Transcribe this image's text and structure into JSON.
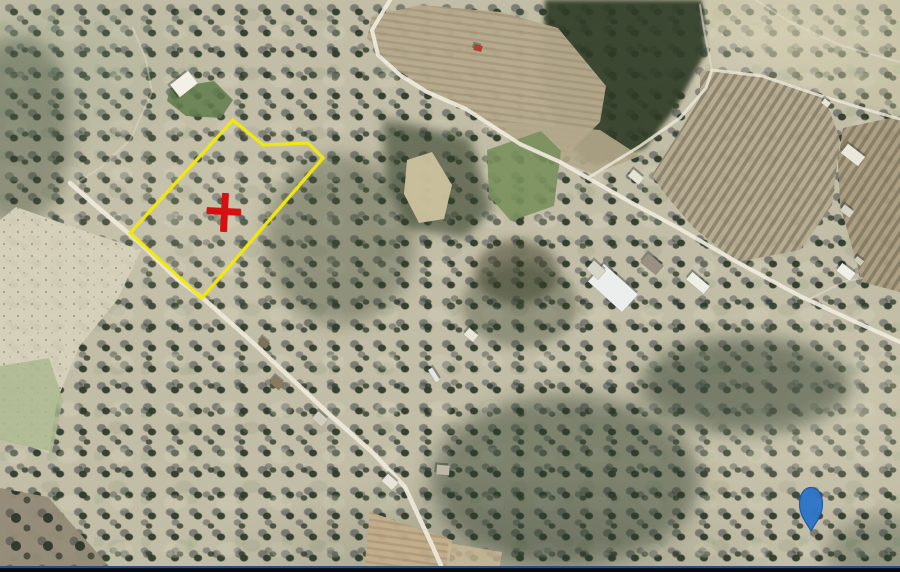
{
  "map": {
    "kind": "satellite-aerial-parcel-view",
    "canvas": {
      "width": 900,
      "height": 572
    },
    "ground_color": "#c2bda6",
    "parcel": {
      "stroke": "#f3e80b",
      "stroke_width": 3.3,
      "vertices": [
        [
          233,
          120
        ],
        [
          263,
          145
        ],
        [
          308,
          143
        ],
        [
          323,
          158
        ],
        [
          202,
          298
        ],
        [
          130,
          233
        ]
      ]
    },
    "markers": {
      "red_cross": {
        "cx": 225,
        "cy": 212,
        "color": "#d61010",
        "h_bar": {
          "x": 206.5,
          "y": 208,
          "w": 34.5,
          "h": 7
        },
        "v_bar": {
          "x": 221,
          "y": 193,
          "w": 7,
          "h": 39
        },
        "tilt_deg": 3
      },
      "blue_pin": {
        "cx": 811,
        "top": 487.5,
        "bulb_cy": 504,
        "r": 11.5,
        "tip_y": 531,
        "fill": "#2d74c9",
        "stroke": "#1e55a0"
      }
    },
    "shades": [
      {
        "name": "forest-top-middle",
        "shape": "polygon",
        "points": [
          [
            545,
            0
          ],
          [
            702,
            0
          ],
          [
            706,
            52
          ],
          [
            676,
            108
          ],
          [
            645,
            148
          ],
          [
            596,
            166
          ],
          [
            558,
            140
          ],
          [
            543,
            78
          ]
        ],
        "fill": "#2d3b27",
        "opacity": 0.9,
        "blur": "s"
      },
      {
        "name": "scrub-mid",
        "shape": "polygon",
        "points": [
          [
            382,
            118
          ],
          [
            470,
            138
          ],
          [
            492,
            210
          ],
          [
            465,
            238
          ],
          [
            408,
            228
          ],
          [
            386,
            180
          ]
        ],
        "fill": "#33402c",
        "opacity": 0.6,
        "blur": "m"
      },
      {
        "name": "dense-right-of-parcel",
        "shape": "ellipse",
        "cx": 340,
        "cy": 240,
        "rx": 75,
        "ry": 85,
        "fill": "#313f2c",
        "opacity": 0.35,
        "blur": "l"
      },
      {
        "name": "dark-patch-mid",
        "shape": "ellipse",
        "cx": 517,
        "cy": 272,
        "rx": 42,
        "ry": 32,
        "fill": "#3a3a28",
        "opacity": 0.5,
        "blur": "m"
      },
      {
        "name": "dark-below-green-field",
        "shape": "ellipse",
        "cx": 520,
        "cy": 305,
        "rx": 58,
        "ry": 42,
        "fill": "#313f2c",
        "opacity": 0.35,
        "blur": "m"
      },
      {
        "name": "dense-bottom-center",
        "shape": "ellipse",
        "cx": 565,
        "cy": 480,
        "rx": 135,
        "ry": 85,
        "fill": "#2c3a29",
        "opacity": 0.45,
        "blur": "l"
      },
      {
        "name": "dense-band-mid-right",
        "shape": "ellipse",
        "cx": 745,
        "cy": 385,
        "rx": 105,
        "ry": 48,
        "fill": "#2c3a29",
        "opacity": 0.5,
        "blur": "l"
      },
      {
        "name": "dense-left-edge",
        "shape": "ellipse",
        "cx": 18,
        "cy": 130,
        "rx": 55,
        "ry": 95,
        "fill": "#2f3d2c",
        "opacity": 0.35,
        "blur": "l"
      },
      {
        "name": "dense-bottom-right-corner",
        "shape": "ellipse",
        "cx": 885,
        "cy": 555,
        "rx": 60,
        "ry": 40,
        "fill": "#2c3a29",
        "opacity": 0.3,
        "blur": "l"
      }
    ],
    "fields": [
      {
        "name": "plowed-field-top-center",
        "fill": "#b6aa8e",
        "opacity": 0.96,
        "texture": "furrows",
        "points": [
          [
            372,
            16
          ],
          [
            420,
            5
          ],
          [
            500,
            12
          ],
          [
            558,
            28
          ],
          [
            606,
            86
          ],
          [
            600,
            122
          ],
          [
            562,
            160
          ],
          [
            520,
            142
          ],
          [
            466,
            108
          ],
          [
            426,
            90
          ],
          [
            386,
            61
          ],
          [
            367,
            38
          ]
        ]
      },
      {
        "name": "tan-strip-above-road",
        "fill": "#b3a78b",
        "opacity": 0.9,
        "points": [
          [
            505,
            122
          ],
          [
            600,
            130
          ],
          [
            640,
            156
          ],
          [
            594,
            174
          ],
          [
            552,
            158
          ],
          [
            508,
            140
          ]
        ]
      },
      {
        "name": "plowed-field-right",
        "fill": "#b6aa90",
        "opacity": 0.95,
        "texture": "rows",
        "points": [
          [
            700,
            70
          ],
          [
            760,
            76
          ],
          [
            802,
            88
          ],
          [
            825,
            98
          ],
          [
            840,
            140
          ],
          [
            832,
            205
          ],
          [
            800,
            250
          ],
          [
            737,
            262
          ],
          [
            694,
            228
          ],
          [
            664,
            193
          ],
          [
            652,
            175
          ],
          [
            682,
            128
          ],
          [
            700,
            98
          ]
        ]
      },
      {
        "name": "vineyard-right-edge",
        "fill": "#ab9d82",
        "opacity": 0.95,
        "texture": "rows",
        "points": [
          [
            843,
            128
          ],
          [
            900,
            116
          ],
          [
            900,
            292
          ],
          [
            862,
            282
          ],
          [
            840,
            205
          ],
          [
            838,
            160
          ]
        ]
      },
      {
        "name": "green-field-center",
        "fill": "#79905c",
        "opacity": 0.9,
        "points": [
          [
            487,
            150
          ],
          [
            541,
            131
          ],
          [
            561,
            151
          ],
          [
            554,
            206
          ],
          [
            511,
            221
          ],
          [
            489,
            196
          ]
        ]
      },
      {
        "name": "green-patch-by-house",
        "fill": "#5f7c4b",
        "opacity": 0.85,
        "points": [
          [
            170,
            88
          ],
          [
            214,
            81
          ],
          [
            233,
            100
          ],
          [
            221,
            118
          ],
          [
            186,
            116
          ],
          [
            167,
            101
          ]
        ]
      },
      {
        "name": "light-field-bottom-left",
        "fill": "#d6d1ba",
        "opacity": 0.95,
        "texture": "speckle",
        "points": [
          [
            16,
            207
          ],
          [
            76,
            228
          ],
          [
            141,
            250
          ],
          [
            117,
            300
          ],
          [
            79,
            347
          ],
          [
            57,
            400
          ],
          [
            49,
            453
          ],
          [
            0,
            437
          ],
          [
            0,
            220
          ]
        ]
      },
      {
        "name": "green-field-bottom-left",
        "fill": "#a9b88e",
        "opacity": 0.8,
        "points": [
          [
            49,
            358
          ],
          [
            63,
            400
          ],
          [
            52,
            452
          ],
          [
            0,
            440
          ],
          [
            0,
            366
          ]
        ]
      },
      {
        "name": "plowed-grove-bottom-left",
        "fill": "#948b78",
        "opacity": 0.97,
        "texture": "trees",
        "points": [
          [
            0,
            488
          ],
          [
            48,
            497
          ],
          [
            114,
            572
          ],
          [
            0,
            572
          ]
        ]
      },
      {
        "name": "dirt-strip-bottom",
        "fill": "#c3ae8b",
        "opacity": 0.95,
        "texture": "furrows",
        "points": [
          [
            370,
            512
          ],
          [
            452,
            540
          ],
          [
            448,
            572
          ],
          [
            364,
            572
          ]
        ]
      },
      {
        "name": "dirt-strip-ext",
        "fill": "#cbb896",
        "opacity": 0.8,
        "points": [
          [
            448,
            543
          ],
          [
            502,
            552
          ],
          [
            499,
            572
          ],
          [
            446,
            572
          ]
        ]
      },
      {
        "name": "bare-soil-patch",
        "fill": "#cec29f",
        "opacity": 0.95,
        "points": [
          [
            407,
            160
          ],
          [
            432,
            152
          ],
          [
            452,
            185
          ],
          [
            444,
            219
          ],
          [
            419,
            223
          ],
          [
            404,
            194
          ]
        ]
      },
      {
        "name": "light-ground-top-right",
        "fill": "#d2cdaa",
        "opacity": 0.3,
        "points": [
          [
            702,
            0
          ],
          [
            900,
            0
          ],
          [
            900,
            112
          ],
          [
            822,
            94
          ],
          [
            756,
            58
          ],
          [
            706,
            20
          ]
        ]
      }
    ],
    "roads": [
      {
        "name": "road-main-diagonal",
        "color": "#eeeadd",
        "width": 4,
        "opacity": 0.92,
        "points": [
          [
            390,
            0
          ],
          [
            372,
            30
          ],
          [
            378,
            55
          ],
          [
            400,
            75
          ],
          [
            427,
            92
          ],
          [
            466,
            109
          ],
          [
            520,
            144
          ],
          [
            560,
            162
          ],
          [
            588,
            178
          ],
          [
            632,
            203
          ],
          [
            680,
            229
          ],
          [
            737,
            262
          ],
          [
            800,
            296
          ],
          [
            858,
            323
          ],
          [
            900,
            342
          ]
        ]
      },
      {
        "name": "road-branch-upper",
        "color": "#eae6d6",
        "width": 3,
        "opacity": 0.85,
        "points": [
          [
            588,
            178
          ],
          [
            640,
            146
          ],
          [
            680,
            118
          ],
          [
            706,
            88
          ],
          [
            712,
            70
          ],
          [
            762,
            76
          ],
          [
            812,
            93
          ],
          [
            868,
            110
          ],
          [
            900,
            119
          ]
        ]
      },
      {
        "name": "path-spur-top",
        "color": "#eae6d6",
        "width": 2,
        "opacity": 0.55,
        "points": [
          [
            712,
            70
          ],
          [
            704,
            30
          ],
          [
            700,
            5
          ]
        ]
      },
      {
        "name": "road-along-parcel",
        "color": "#ece7d8",
        "width": 4.5,
        "opacity": 0.95,
        "points": [
          [
            70,
            183
          ],
          [
            95,
            205
          ],
          [
            140,
            243
          ],
          [
            175,
            277
          ],
          [
            205,
            300
          ],
          [
            250,
            340
          ],
          [
            295,
            382
          ],
          [
            330,
            415
          ],
          [
            372,
            452
          ],
          [
            405,
            487
          ],
          [
            418,
            515
          ],
          [
            432,
            545
          ],
          [
            443,
            570
          ]
        ]
      },
      {
        "name": "trail-top-left",
        "color": "#e6e2d2",
        "width": 2,
        "opacity": 0.4,
        "points": [
          [
            133,
            28
          ],
          [
            146,
            60
          ],
          [
            152,
            92
          ],
          [
            130,
            140
          ],
          [
            100,
            168
          ],
          [
            78,
            182
          ]
        ]
      },
      {
        "name": "trail-top-right",
        "color": "#e6e2d2",
        "width": 2,
        "opacity": 0.45,
        "points": [
          [
            756,
            0
          ],
          [
            790,
            22
          ],
          [
            840,
            45
          ],
          [
            885,
            58
          ],
          [
            900,
            62
          ]
        ]
      },
      {
        "name": "trail-farm-right",
        "color": "#e6e2d2",
        "width": 2,
        "opacity": 0.5,
        "points": [
          [
            808,
            300
          ],
          [
            843,
            282
          ],
          [
            862,
            278
          ]
        ]
      }
    ],
    "buildings": [
      {
        "name": "house-top-left",
        "cx": 184,
        "cy": 84,
        "w": 23,
        "h": 16,
        "rot": -38,
        "fill": "#f3f0e6"
      },
      {
        "name": "warehouse-white",
        "cx": 613,
        "cy": 288,
        "w": 46,
        "h": 24,
        "rot": 42,
        "fill": "#eceded"
      },
      {
        "name": "warehouse-annex",
        "cx": 596,
        "cy": 270,
        "w": 16,
        "h": 12,
        "rot": 42,
        "fill": "#d8d5c8"
      },
      {
        "name": "barn-gray",
        "cx": 652,
        "cy": 264,
        "w": 20,
        "h": 12,
        "rot": 40,
        "fill": "#989080"
      },
      {
        "name": "shed-white-mid",
        "cx": 698,
        "cy": 283,
        "w": 23,
        "h": 10,
        "rot": 40,
        "fill": "#efeee4"
      },
      {
        "name": "shed-small-junction",
        "cx": 636,
        "cy": 177,
        "w": 14,
        "h": 9,
        "rot": 40,
        "fill": "#e6e3d3"
      },
      {
        "name": "farm-building-top-right",
        "cx": 853,
        "cy": 155,
        "w": 22,
        "h": 12,
        "rot": 38,
        "fill": "#eae8db"
      },
      {
        "name": "shed-right-1",
        "cx": 847,
        "cy": 211,
        "w": 12,
        "h": 8,
        "rot": 38,
        "fill": "#d9d5c5"
      },
      {
        "name": "farmhouse-right",
        "cx": 846,
        "cy": 272,
        "w": 17,
        "h": 10,
        "rot": 38,
        "fill": "#f0efe7"
      },
      {
        "name": "shed-right-2",
        "cx": 859,
        "cy": 261,
        "w": 9,
        "h": 6,
        "rot": 38,
        "fill": "#cfcbbb"
      },
      {
        "name": "hut-orchard-1",
        "cx": 471,
        "cy": 335,
        "w": 12,
        "h": 9,
        "rot": 40,
        "fill": "#e9e6d7"
      },
      {
        "name": "hut-streak",
        "cx": 434,
        "cy": 375,
        "w": 15,
        "h": 5,
        "rot": 58,
        "fill": "#e3e6e2"
      },
      {
        "name": "shed-roadside",
        "cx": 390,
        "cy": 482,
        "w": 14,
        "h": 10,
        "rot": 42,
        "fill": "#e8e5d8"
      },
      {
        "name": "hut-orchard-2",
        "cx": 443,
        "cy": 470,
        "w": 13,
        "h": 10,
        "rot": 5,
        "fill": "#bdb8a8"
      },
      {
        "name": "hut-brown-1",
        "cx": 277,
        "cy": 383,
        "w": 12,
        "h": 9,
        "rot": 40,
        "fill": "#8a7a5e"
      },
      {
        "name": "hut-brown-2",
        "cx": 264,
        "cy": 343,
        "w": 10,
        "h": 7,
        "rot": 40,
        "fill": "#80715a"
      },
      {
        "name": "hut-gray-road",
        "cx": 320,
        "cy": 419,
        "w": 13,
        "h": 10,
        "rot": 42,
        "fill": "#d0cdc0"
      },
      {
        "name": "red-object-field",
        "cx": 478,
        "cy": 48,
        "w": 8,
        "h": 6,
        "rot": 15,
        "fill": "#b2402c"
      },
      {
        "name": "tiny-shed-topright",
        "cx": 826,
        "cy": 103,
        "w": 8,
        "h": 6,
        "rot": 38,
        "fill": "#e7e5d6"
      }
    ],
    "statusbar": {
      "line_color": "#2c4f82",
      "bar_color": "#05080d"
    }
  }
}
